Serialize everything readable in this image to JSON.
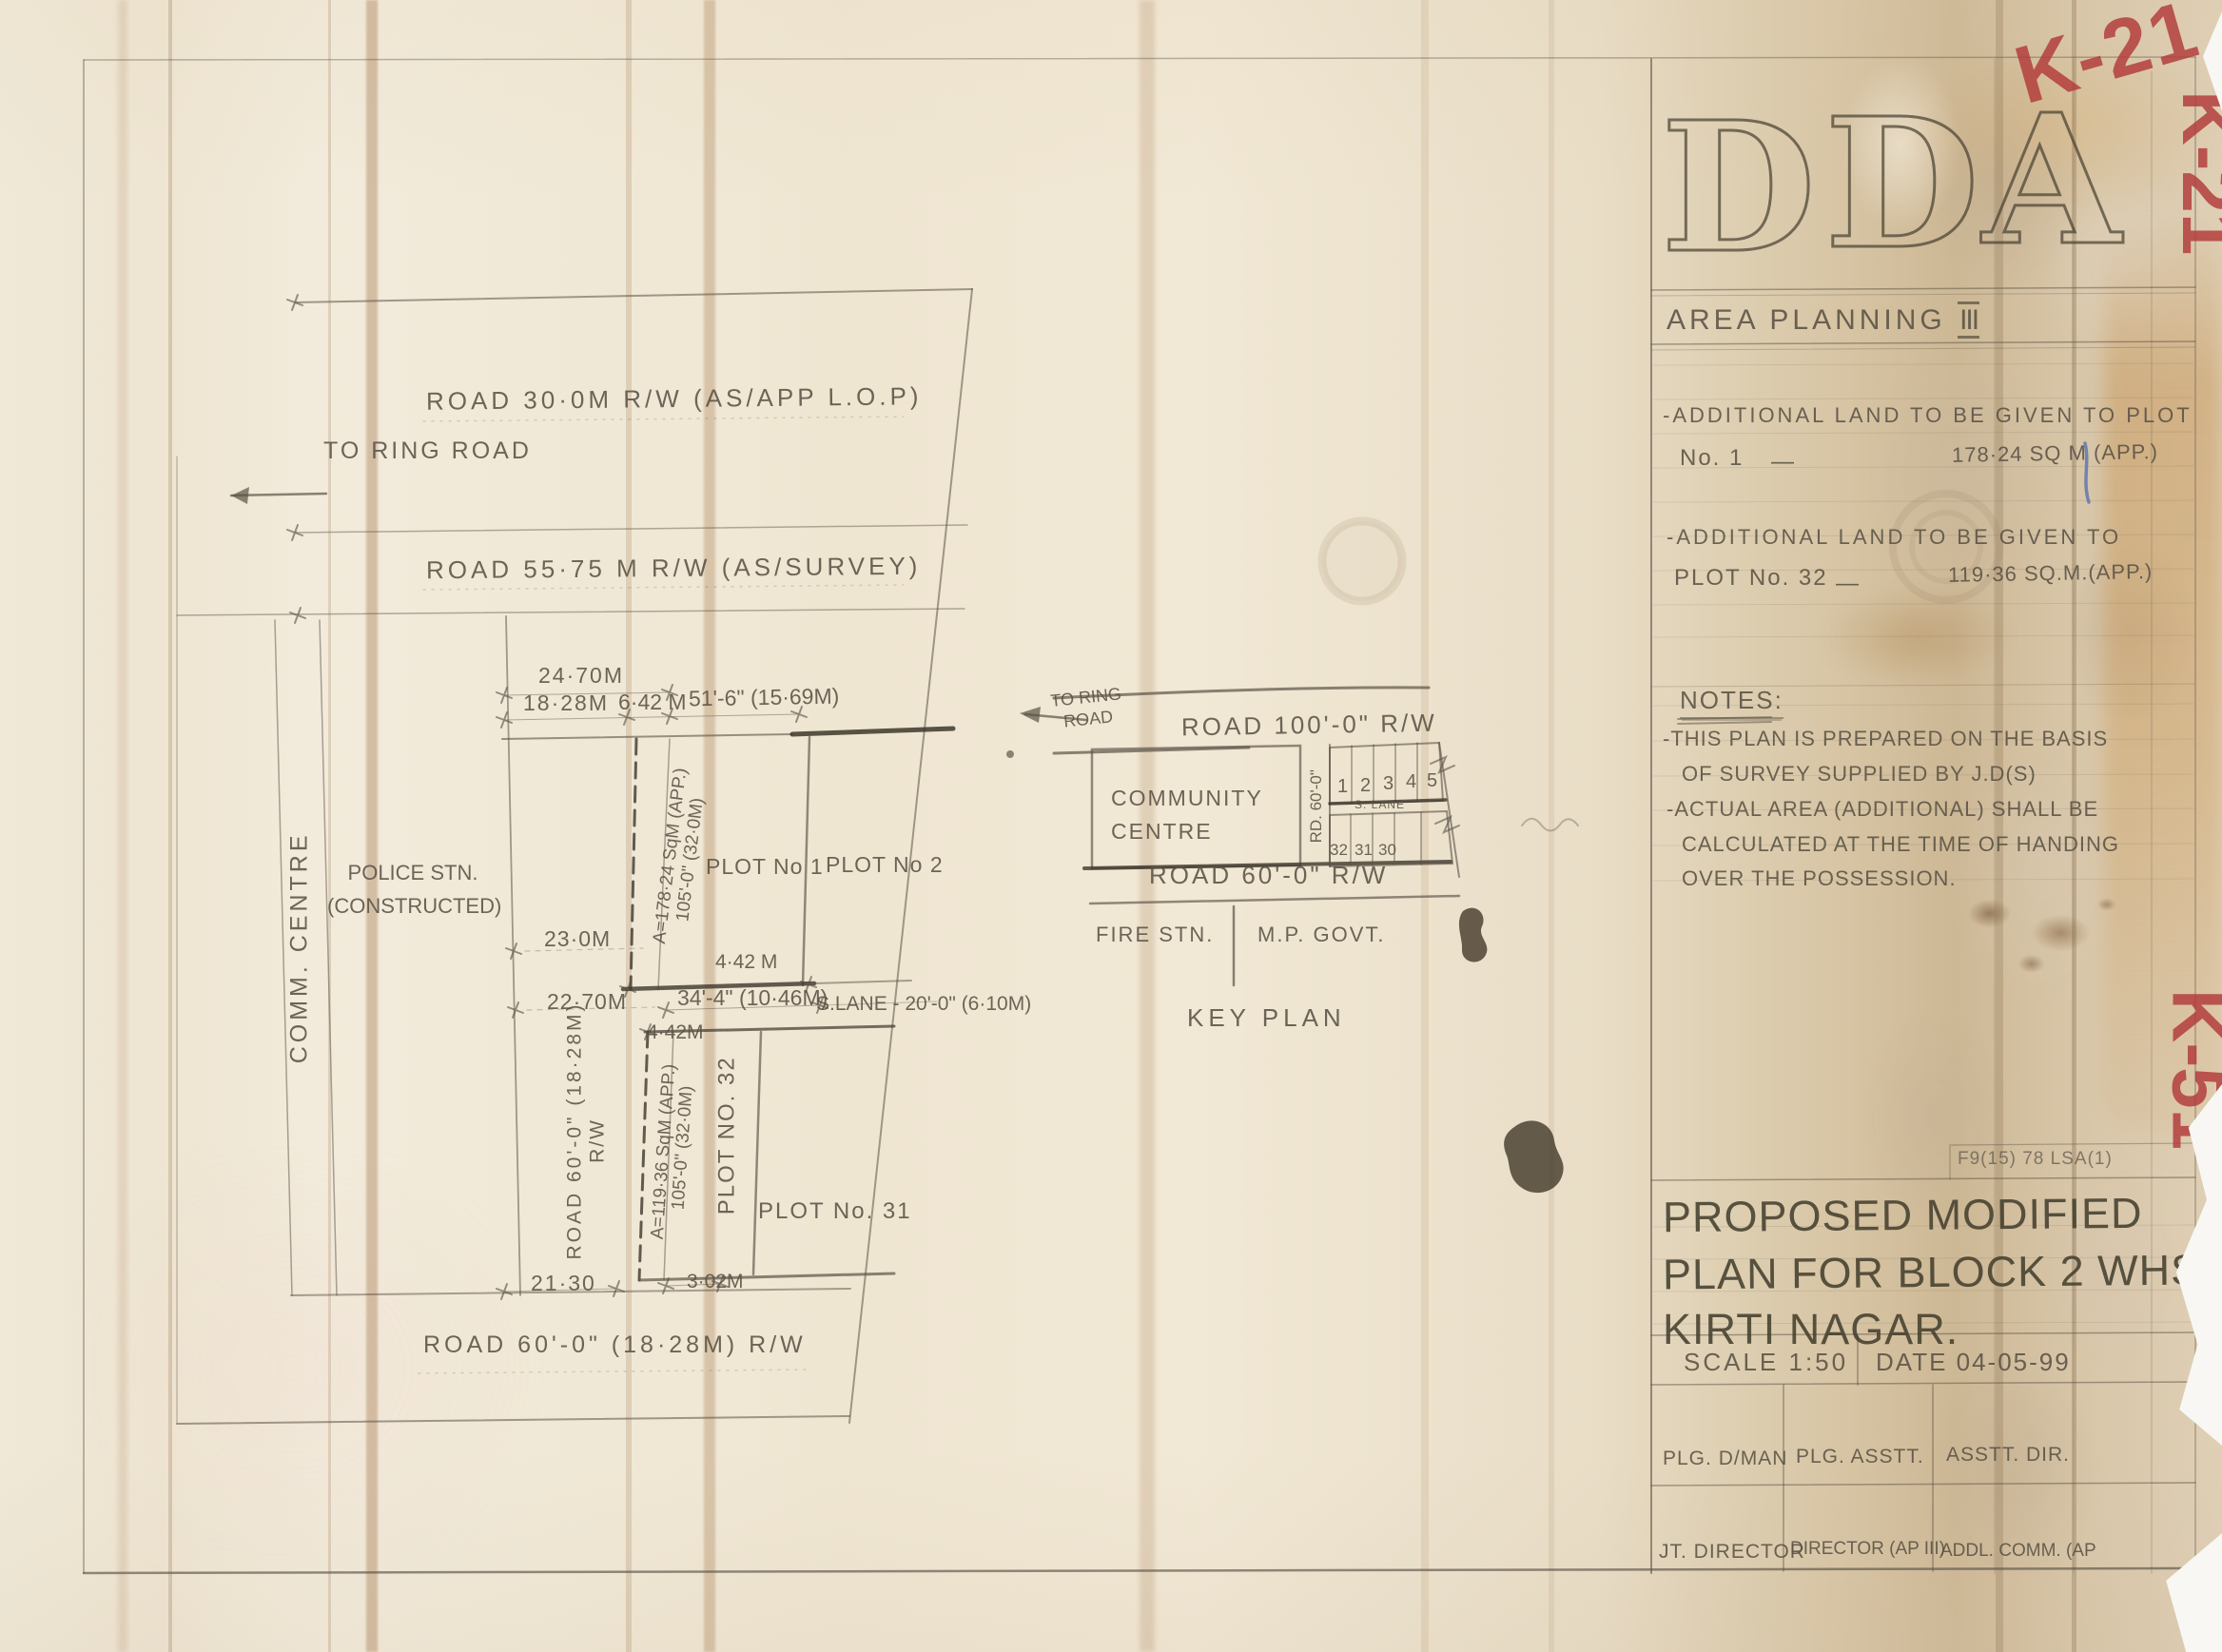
{
  "red_marks": {
    "top": "K-21",
    "side_top": "K-21",
    "side_bottom": "K-51"
  },
  "branding": {
    "letters": [
      "D",
      "D",
      "A"
    ],
    "dept": "AREA PLANNING",
    "dept_num": "III"
  },
  "title_block": {
    "alloc1": {
      "l1": "-ADDITIONAL LAND TO BE GIVEN TO PLOT",
      "l2": "No. 1",
      "dash": "—",
      "val": "178·24 SQ M (APP.)"
    },
    "alloc2": {
      "l1": "-ADDITIONAL LAND TO BE GIVEN TO",
      "l2": "PLOT No. 32",
      "dash": "—",
      "val": "119·36 SQ.M.(APP.)"
    },
    "notes_heading": "NOTES:",
    "notes": [
      "-THIS PLAN IS PREPARED ON THE BASIS",
      "OF SURVEY SUPPLIED BY J.D(S)",
      "-ACTUAL AREA (ADDITIONAL) SHALL BE",
      "CALCULATED AT THE TIME OF HANDING",
      "OVER THE POSSESSION."
    ],
    "ref_no": "F9(15) 78 LSA(1)",
    "title_lines": [
      "PROPOSED MODIFIED",
      "PLAN FOR BLOCK 2 WHS",
      "KIRTI NAGAR."
    ],
    "scale": "SCALE 1:50",
    "date": "DATE 04-05-99",
    "sign_row1": [
      "PLG. D/MAN",
      "PLG. ASSTT.",
      "ASSTT. DIR."
    ],
    "sign_row2": [
      "JT. DIRECTOR",
      "DIRECTOR (AP III)",
      "ADDL. COMM. (AP"
    ]
  },
  "plan": {
    "road_30m": "ROAD 30·0M R/W  (AS/APP L.O.P)",
    "to_ring_road": "TO RING ROAD",
    "road_5575": "ROAD 55·75 M R/W (AS/SURVEY)",
    "dims": {
      "d2470": "24·70M",
      "d1828": "18·28M",
      "d642": "6·42 M",
      "d516": "51'-6\" (15·69M)",
      "d230": "23·0M",
      "d2270": "22·70M",
      "d442a": "4·42 M",
      "d344": "34'-4\" (10·46M)",
      "slane": "S.LANE - 20'-0\" (6·10M)",
      "d442b": "4·42M",
      "d2130": "21·30",
      "d302": "3·02M"
    },
    "strip1_area": "A=178·24 SqM (APP.)",
    "strip1_dim": "105'-0\" (32·0M)",
    "strip2_area": "A=119·36 SqM (APP.)",
    "strip2_dim": "105'-0\" (32·0M)",
    "plot1": "PLOT No 1",
    "plot2": "PLOT No 2",
    "plot32": "PLOT NO. 32",
    "plot31": "PLOT No. 31",
    "road60_vert_l1": "ROAD 60'-0\" (18·28M)",
    "road60_vert_l2": "R/W",
    "road60_bottom": "ROAD 60'-0\" (18·28M) R/W",
    "police_l1": "POLICE STN.",
    "police_l2": "(CONSTRUCTED)",
    "comm_centre": "COMM. CENTRE"
  },
  "key_plan": {
    "to_ring_road": "TO RING ROAD",
    "road100": "ROAD 100'-0\" R/W",
    "community_l1": "COMMUNITY",
    "community_l2": "CENTRE",
    "rd60_vert": "RD. 60'-0\"",
    "plot_numbers_top": [
      "1",
      "2",
      "3",
      "4",
      "5"
    ],
    "slane": "S. LANE",
    "plot_numbers_bottom": [
      "32",
      "31",
      "30"
    ],
    "road60": "ROAD 60'-0\" R/W",
    "fire_stn": "FIRE STN.",
    "mp_govt": "M.P. GOVT.",
    "title": "KEY PLAN"
  }
}
